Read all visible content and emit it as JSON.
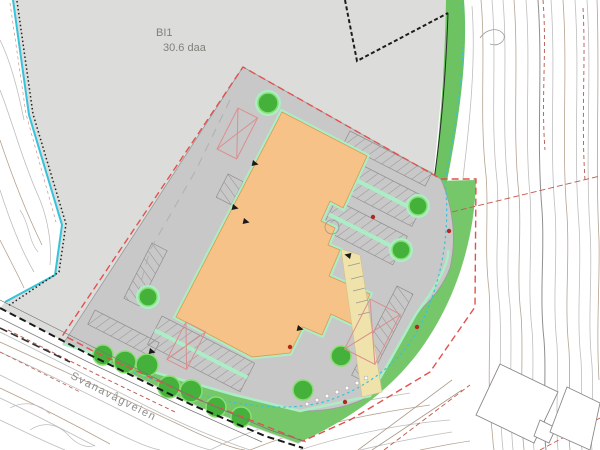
{
  "plan": {
    "zone_label": {
      "code": "BI1",
      "area": "30.6 daa"
    },
    "road_label": "Svanavågveien"
  },
  "colors": {
    "existing_ground": "#dcdcda",
    "paved_site": "#c8c8c8",
    "building": "#f6c287",
    "walkway": "#efe2ab",
    "green_area": "#76c76a",
    "mint_curb": "#abeec6",
    "tree": "#43b13a",
    "stream": "#36c3da",
    "plan_boundary": "#e2514d",
    "road_line": "#1a1a1a",
    "contour_gray": "#bdbdbd",
    "contour_brown": "#b6a28f",
    "property_line_red": "#b4574b"
  }
}
